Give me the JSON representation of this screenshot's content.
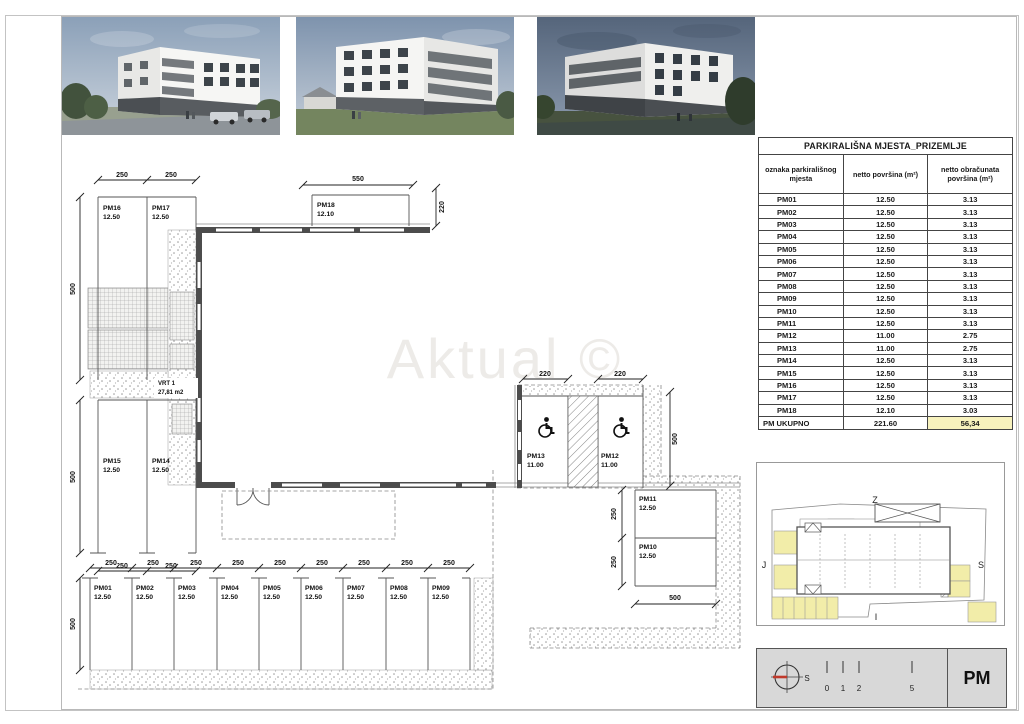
{
  "watermark": "Aktual ©",
  "colors": {
    "stall_highlight": "#f2eda9",
    "total_highlight": "#f7f2bd",
    "wall": "#4c4c4c",
    "north_needle_red": "#c0392b"
  },
  "plan": {
    "dim": {
      "w220": "220",
      "w250": "250",
      "w500": "500",
      "w550": "550"
    },
    "vrt": {
      "name": "VRT 1",
      "area": "27,81 m2"
    },
    "stalls": {
      "pm01": {
        "id": "PM01",
        "area": "12.50"
      },
      "pm02": {
        "id": "PM02",
        "area": "12.50"
      },
      "pm03": {
        "id": "PM03",
        "area": "12.50"
      },
      "pm04": {
        "id": "PM04",
        "area": "12.50"
      },
      "pm05": {
        "id": "PM05",
        "area": "12.50"
      },
      "pm06": {
        "id": "PM06",
        "area": "12.50"
      },
      "pm07": {
        "id": "PM07",
        "area": "12.50"
      },
      "pm08": {
        "id": "PM08",
        "area": "12.50"
      },
      "pm09": {
        "id": "PM09",
        "area": "12.50"
      },
      "pm10": {
        "id": "PM10",
        "area": "12.50"
      },
      "pm11": {
        "id": "PM11",
        "area": "12.50"
      },
      "pm12": {
        "id": "PM12",
        "area": "11.00"
      },
      "pm13": {
        "id": "PM13",
        "area": "11.00"
      },
      "pm14": {
        "id": "PM14",
        "area": "12.50"
      },
      "pm15": {
        "id": "PM15",
        "area": "12.50"
      },
      "pm16": {
        "id": "PM16",
        "area": "12.50"
      },
      "pm17": {
        "id": "PM17",
        "area": "12.50"
      },
      "pm18": {
        "id": "PM18",
        "area": "12.10"
      }
    }
  },
  "table": {
    "title": "PARKIRALIŠNA MJESTA_PRIZEMLJE",
    "columns": [
      "oznaka parkirališnog mjesta",
      "netto površina (m²)",
      "netto obračunata površina (m²)"
    ],
    "rows": [
      [
        "PM01",
        "12.50",
        "3.13"
      ],
      [
        "PM02",
        "12.50",
        "3.13"
      ],
      [
        "PM03",
        "12.50",
        "3.13"
      ],
      [
        "PM04",
        "12.50",
        "3.13"
      ],
      [
        "PM05",
        "12.50",
        "3.13"
      ],
      [
        "PM06",
        "12.50",
        "3.13"
      ],
      [
        "PM07",
        "12.50",
        "3.13"
      ],
      [
        "PM08",
        "12.50",
        "3.13"
      ],
      [
        "PM09",
        "12.50",
        "3.13"
      ],
      [
        "PM10",
        "12.50",
        "3.13"
      ],
      [
        "PM11",
        "12.50",
        "3.13"
      ],
      [
        "PM12",
        "11.00",
        "2.75"
      ],
      [
        "PM13",
        "11.00",
        "2.75"
      ],
      [
        "PM14",
        "12.50",
        "3.13"
      ],
      [
        "PM15",
        "12.50",
        "3.13"
      ],
      [
        "PM16",
        "12.50",
        "3.13"
      ],
      [
        "PM17",
        "12.50",
        "3.13"
      ],
      [
        "PM18",
        "12.10",
        "3.03"
      ]
    ],
    "total": [
      "PM UKUPNO",
      "221.60",
      "56,34"
    ]
  },
  "site_plan": {
    "top": "Z",
    "left": "J",
    "right": "S",
    "bottom": "I"
  },
  "title_block": {
    "north_label": "S",
    "scale_ticks": [
      "0",
      "1",
      "2",
      "5"
    ],
    "sheet_code": "PM"
  }
}
